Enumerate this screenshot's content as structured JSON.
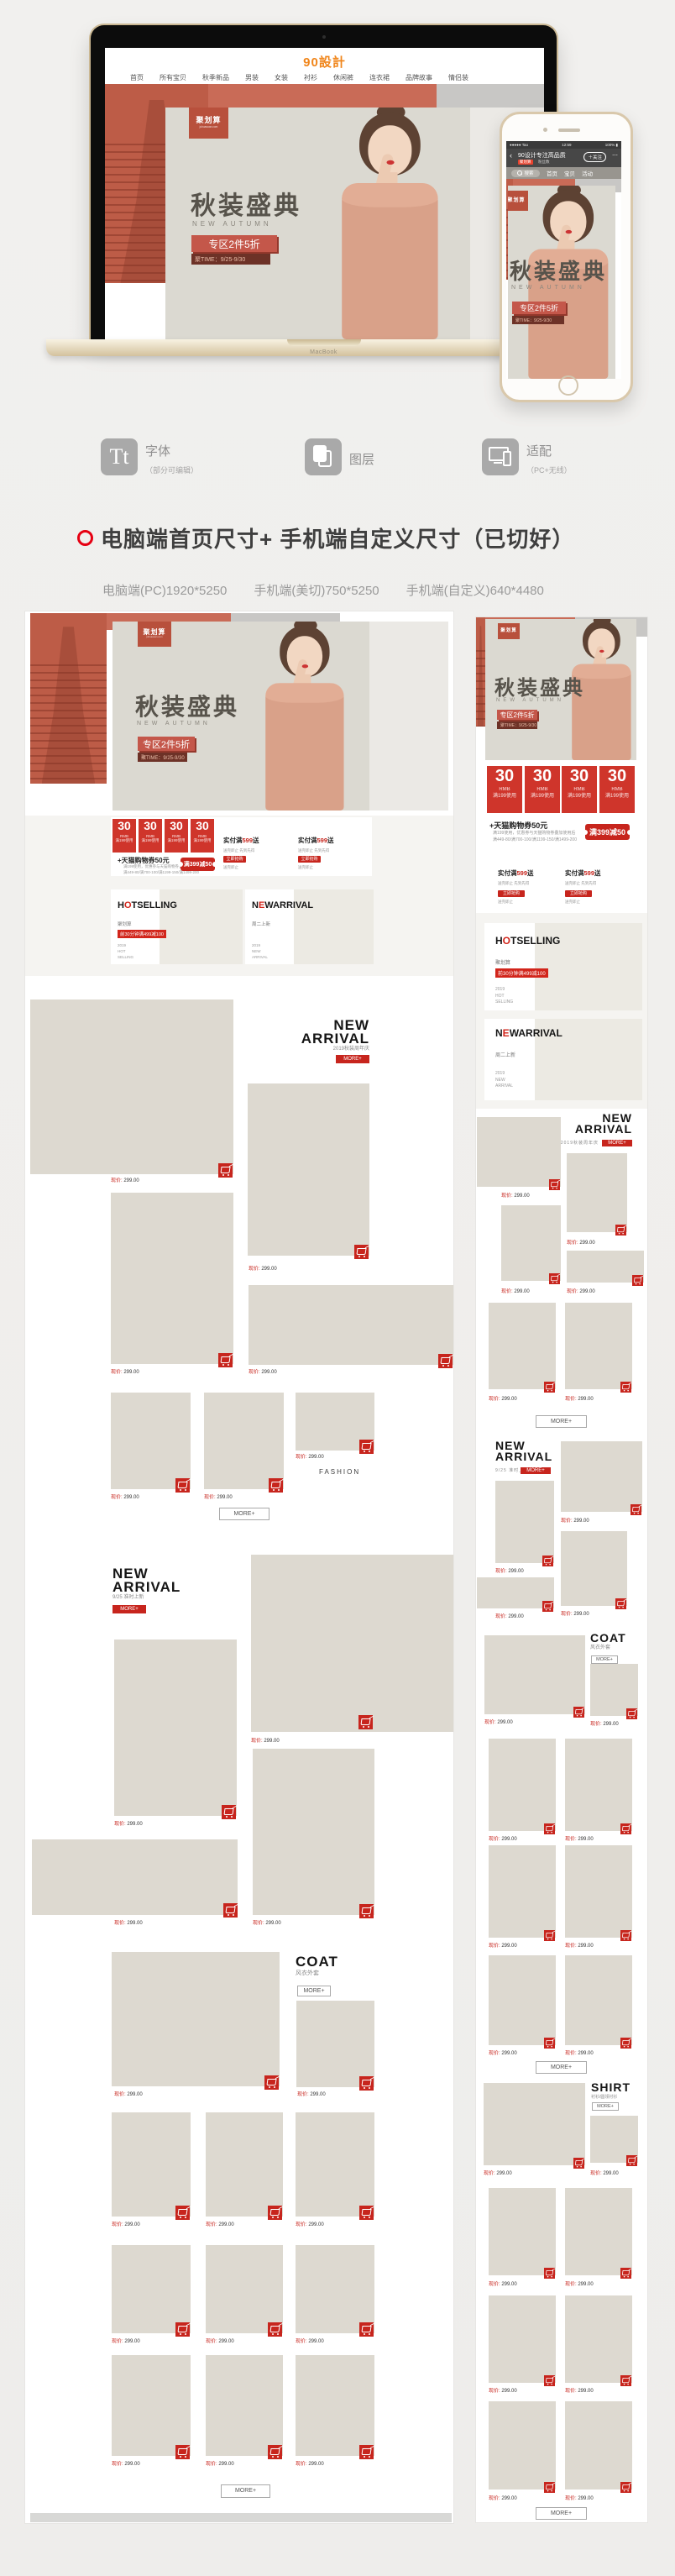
{
  "brand": {
    "logo": "90設計"
  },
  "macbook": {
    "label": "MacBook",
    "nav": [
      "首页",
      "所有宝贝",
      "秋季新品",
      "男装",
      "女装",
      "衬衫",
      "休闲裤",
      "连衣裙",
      "品牌故事",
      "情侣装"
    ]
  },
  "banner": {
    "juhuasuan": "聚划算",
    "juhuasuan_sub": "juhuasuan.com",
    "title": "秋装盛典",
    "subtitle": "NEW AUTUMN",
    "button": "专区2件5折",
    "time": "聚TIME：9/25-9/30"
  },
  "phone": {
    "carrier": "●●●●● Tao",
    "time": "12:59",
    "battery": "100% ▮",
    "back": "‹",
    "shop_title": "90设计专注高品质",
    "shop_tag": "聚划算",
    "shop_fans": "粉丝数",
    "follow": "＋关注",
    "more_dots": "⋯",
    "tab_search": "搜索",
    "tabs": [
      "首页",
      "宝贝",
      "活动"
    ]
  },
  "features": [
    {
      "icon": "font-icon",
      "glyph": "Tt",
      "label": "字体",
      "sub": "（部分可编辑）"
    },
    {
      "icon": "layers-icon",
      "label": "图层",
      "sub": ""
    },
    {
      "icon": "devices-icon",
      "label": "适配",
      "sub": "（PC+无线）"
    }
  ],
  "headline": {
    "text": "电脑端首页尺寸+ 手机端自定义尺寸（已切好）"
  },
  "dims": [
    "电脑端(PC)1920*5250",
    "手机端(美切)750*5250",
    "手机端(自定义)640*4480"
  ],
  "coupon": {
    "value": "30",
    "unit": "RMB",
    "cond": "满199使用",
    "voucher_title": "+天猫购物券50元",
    "voucher_line1": "满199使用，优惠券与天猫购物券叠加使用后",
    "voucher_line2": "满449-80/满700-100/满1199-150/满1499-200",
    "ticket": "满399减50",
    "gift_pre": "实付满",
    "gift_amount": "599",
    "gift_post": "送",
    "gift_sub": "送完即止 先到先得",
    "gift_btn": "立即抢购",
    "gift_note": "送完即止"
  },
  "promo": {
    "hot": {
      "t1a": "H",
      "t1b": "O",
      "t1c": "T",
      "t2": "SELLING",
      "sub": "聚划算",
      "label": "前30分钟满499减100",
      "lines": [
        "2019",
        "HOT",
        "SELLING"
      ]
    },
    "newc": {
      "t1a": "N",
      "t1b": "E",
      "t1c": "W",
      "t2": "ARRIVAL",
      "sub": "周二上新",
      "lines": [
        "2019",
        "NEW",
        "ARRIVAL"
      ]
    }
  },
  "sections": {
    "na1": {
      "l1": "NEW",
      "l2": "ARRIVAL",
      "sub": "2019秋装周年庆"
    },
    "na2": {
      "l1": "NEW",
      "l2": "ARRIVAL",
      "sub": "9/25 准时上新"
    },
    "coat": {
      "l1": "COAT",
      "sub": "风衣外套"
    },
    "shirt": {
      "l1": "SHIRT",
      "sub": "衬衫/圆领衬衫"
    },
    "fashion": "FASHION",
    "more": "MORE+"
  },
  "product": {
    "price_label": "现价:",
    "price_value": "299.00"
  },
  "colors": {
    "accent": "#c7251d",
    "salmon": "#c96b57",
    "placeholder": "#ddd9d0",
    "logo_orange": "#f0851a"
  }
}
